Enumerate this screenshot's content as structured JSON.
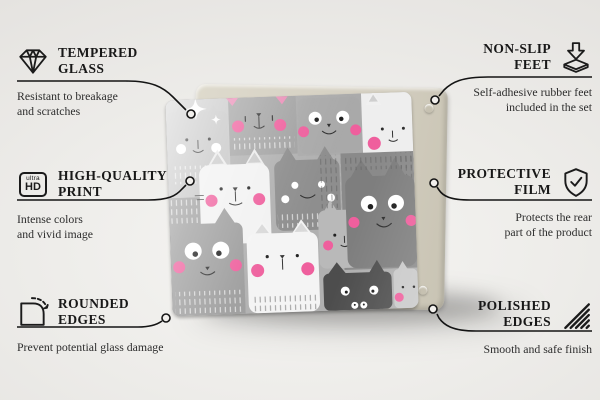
{
  "canvas": {
    "width": 600,
    "height": 400,
    "background": "#eeedea",
    "line_color": "#141414"
  },
  "product": {
    "type": "glass board product photo",
    "print_description": "cartoon cats pattern in shades of gray with pink cheeks",
    "back_panel_color": "#d5d0c2",
    "accent_pink": "#ef5f9d",
    "rubber_feet_count_visible": 2
  },
  "features": [
    {
      "id": "tempered-glass",
      "icon": "diamond-icon",
      "title_line1": "TEMPERED",
      "title_line2": "GLASS",
      "desc_line1": "Resistant to breakage",
      "desc_line2": "and scratches"
    },
    {
      "id": "non-slip-feet",
      "icon": "rubber-feet-icon",
      "title_line1": "NON-SLIP",
      "title_line2": "FEET",
      "desc_line1": "Self-adhesive rubber feet",
      "desc_line2": "included in the set"
    },
    {
      "id": "high-quality-print",
      "icon": "ultra-hd-icon",
      "title_line1": "HIGH-QUALITY",
      "title_line2": "PRINT",
      "desc_line1": "Intense colors",
      "desc_line2": "and vivid image",
      "icon_text_top": "ultra",
      "icon_text_bottom": "HD"
    },
    {
      "id": "protective-film",
      "icon": "shield-check-icon",
      "title_line1": "PROTECTIVE",
      "title_line2": "FILM",
      "desc_line1": "Protects the rear",
      "desc_line2": "part of the product"
    },
    {
      "id": "rounded-edges",
      "icon": "rounded-corner-icon",
      "title_line1": "ROUNDED",
      "title_line2": "EDGES",
      "desc_line1": "Prevent potential glass damage",
      "desc_line2": ""
    },
    {
      "id": "polished-edges",
      "icon": "hatched-edges-icon",
      "title_line1": "POLISHED",
      "title_line2": "EDGES",
      "desc_line1": "Smooth and safe finish",
      "desc_line2": ""
    }
  ]
}
